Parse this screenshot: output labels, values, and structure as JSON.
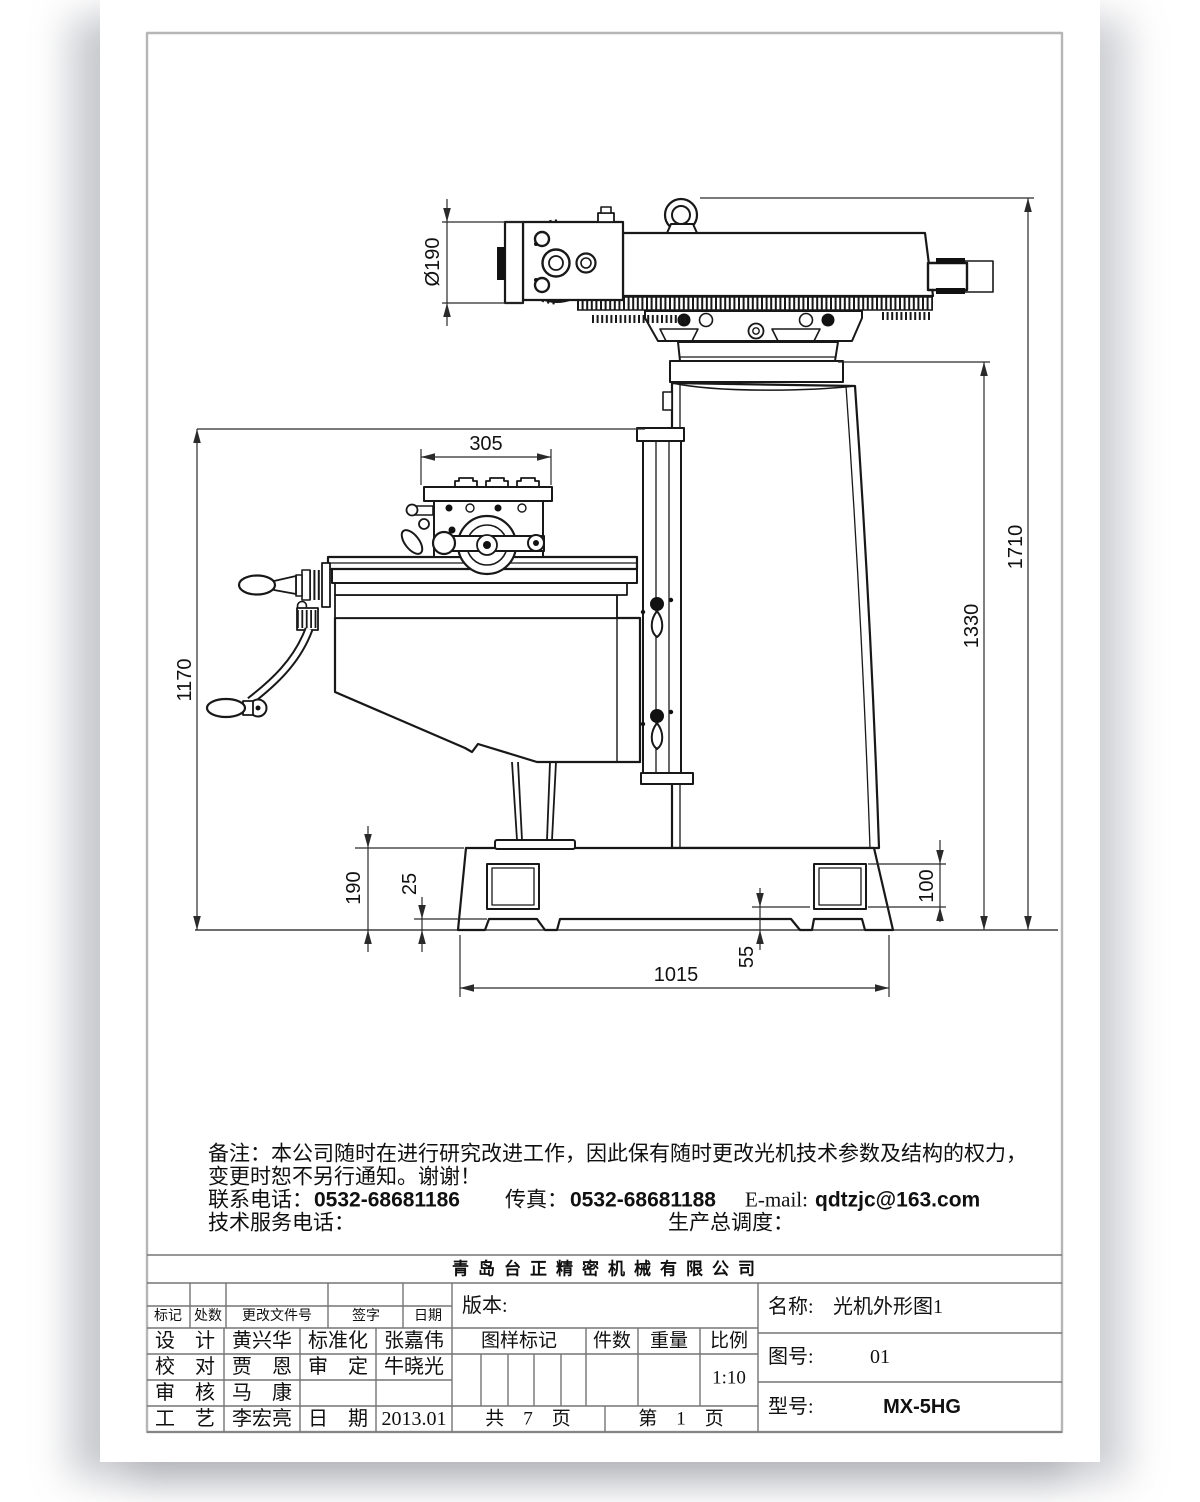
{
  "dims": {
    "head_dia": "Ø190",
    "table_width": "305",
    "overall_height": "1710",
    "swivel_height": "1330",
    "knee_top_height": "1170",
    "base_height": "190",
    "foot_height": "25",
    "pocket_height": "100",
    "pocket_gap": "55",
    "base_length": "1015"
  },
  "notes": {
    "line1": "备注：本公司随时在进行研究改进工作，因此保有随时更改光机技术参数及结构的权力，",
    "line2": "变更时恕不另行通知。谢谢！",
    "phone_label": "联系电话：",
    "phone_value": "0532-68681186",
    "fax_label": "传真：",
    "fax_value": "0532-68681188",
    "email_label": "E-mail:",
    "email_value": "qdtzjc@163.com",
    "service_label": "技术服务电话：",
    "dispatch_label": "生产总调度："
  },
  "title_block": {
    "company": "青岛台正精密机械有限公司",
    "rev_header": {
      "mark": "标记",
      "qty": "处数",
      "file_no": "更改文件号",
      "sign": "签字",
      "date": "日期"
    },
    "staff": [
      {
        "role": "设　计",
        "name": "黄兴华",
        "role2": "标准化",
        "name2": "张嘉伟"
      },
      {
        "role": "校　对",
        "name": "贾　恩",
        "role2": "审　定",
        "name2": "牛晓光"
      },
      {
        "role": "审　核",
        "name": "马　康",
        "role2": "",
        "name2": ""
      },
      {
        "role": "工　艺",
        "name": "李宏亮",
        "role2": "日　期",
        "name2": "2013.01"
      }
    ],
    "version_label": "版本:",
    "mark_header": "图样标记",
    "pieces": "件数",
    "weight": "重量",
    "scale_label": "比例",
    "scale_value": "1:10",
    "total_pages": "共　7　页",
    "page_no": "第　1　页",
    "name_label": "名称:",
    "name_value": "光机外形图1",
    "fig_no_label": "图号:",
    "fig_no_value": "01",
    "model_label": "型号:",
    "model_value": "MX-5HG"
  }
}
